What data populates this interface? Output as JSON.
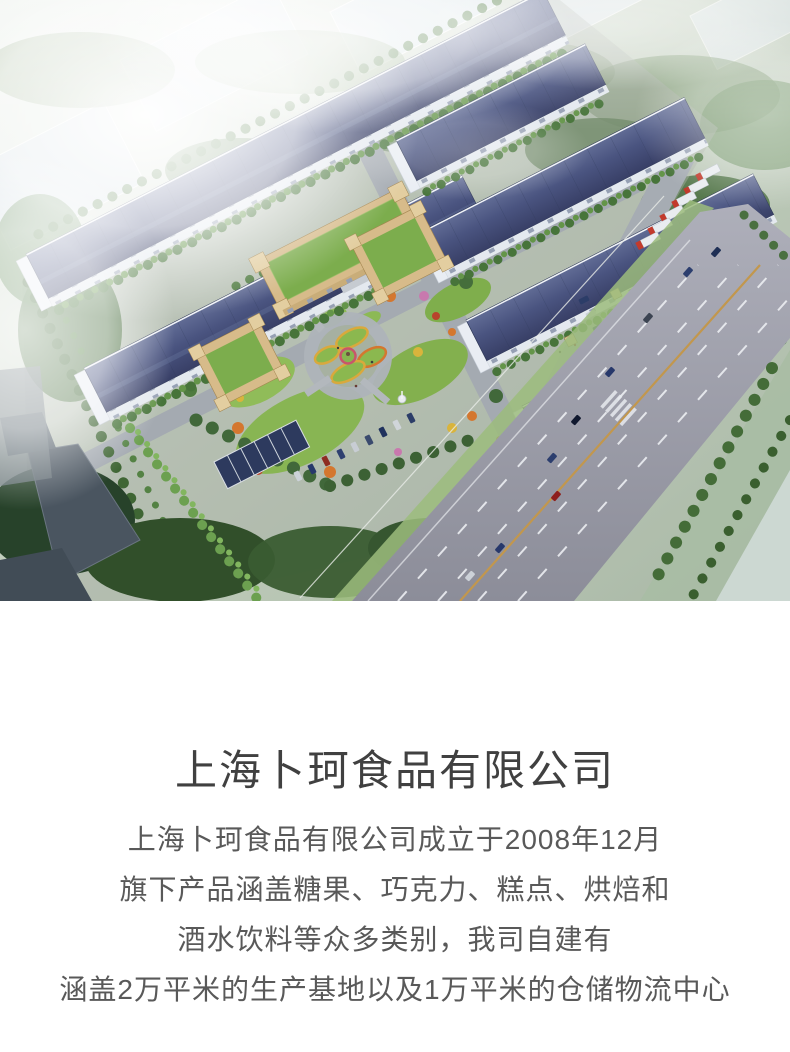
{
  "hero": {
    "image_name": "factory-campus-aerial-rendering",
    "palette": {
      "warehouse_roof": "#46517a",
      "lawn_green": "#88b553",
      "road_gray": "#9b9caa",
      "truck_cab_red": "#c23a2c",
      "office_beige": "#d7bb8a",
      "office_green_roof": "#7cad4d",
      "haze_white": "#ffffff"
    }
  },
  "company": {
    "title": "上海卜珂食品有限公司",
    "intro_lines": [
      "上海卜珂食品有限公司成立于2008年12月",
      "旗下产品涵盖糖果、巧克力、糕点、烘焙和",
      "酒水饮料等众多类别，我司自建有",
      "涵盖2万平米的生产基地以及1万平米的仓储物流中心"
    ]
  }
}
